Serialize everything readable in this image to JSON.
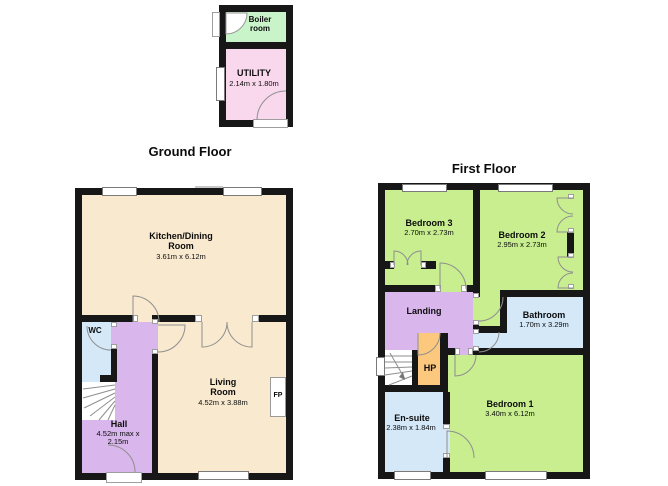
{
  "titles": {
    "ground": "Ground Floor",
    "first": "First Floor"
  },
  "outbuilding": {
    "boiler": {
      "name": "Boiler room"
    },
    "utility": {
      "name": "UTILITY",
      "dims": "2.14m x 1.80m"
    }
  },
  "ground_floor": {
    "kitchen": {
      "name": "Kitchen/Dining Room",
      "dims": "3.61m x 6.12m"
    },
    "living": {
      "name": "Living Room",
      "dims": "4.52m x 3.88m"
    },
    "hall": {
      "name": "Hall",
      "dims": "4.52m max x 2.15m"
    },
    "wc": {
      "name": "WC"
    },
    "fireplace": {
      "label": "FP"
    }
  },
  "first_floor": {
    "bedroom1": {
      "name": "Bedroom 1",
      "dims": "3.40m x 6.12m"
    },
    "bedroom2": {
      "name": "Bedroom 2",
      "dims": "2.95m x 2.73m"
    },
    "bedroom3": {
      "name": "Bedroom 3",
      "dims": "2.70m x 2.73m"
    },
    "bathroom": {
      "name": "Bathroom",
      "dims": "1.70m x 3.29m"
    },
    "ensuite": {
      "name": "En-suite",
      "dims": "2.38m x 1.84m"
    },
    "landing": {
      "name": "Landing"
    },
    "hp": {
      "name": "HP"
    }
  },
  "colors": {
    "wall": "#171717",
    "beige": "#f8e9cf",
    "purple": "#d9b6ec",
    "blue": "#d4e8f8",
    "green": "#c8ee90",
    "mint": "#c9f3c9",
    "pink": "#f9d8ee",
    "orange": "#fbc87d"
  }
}
